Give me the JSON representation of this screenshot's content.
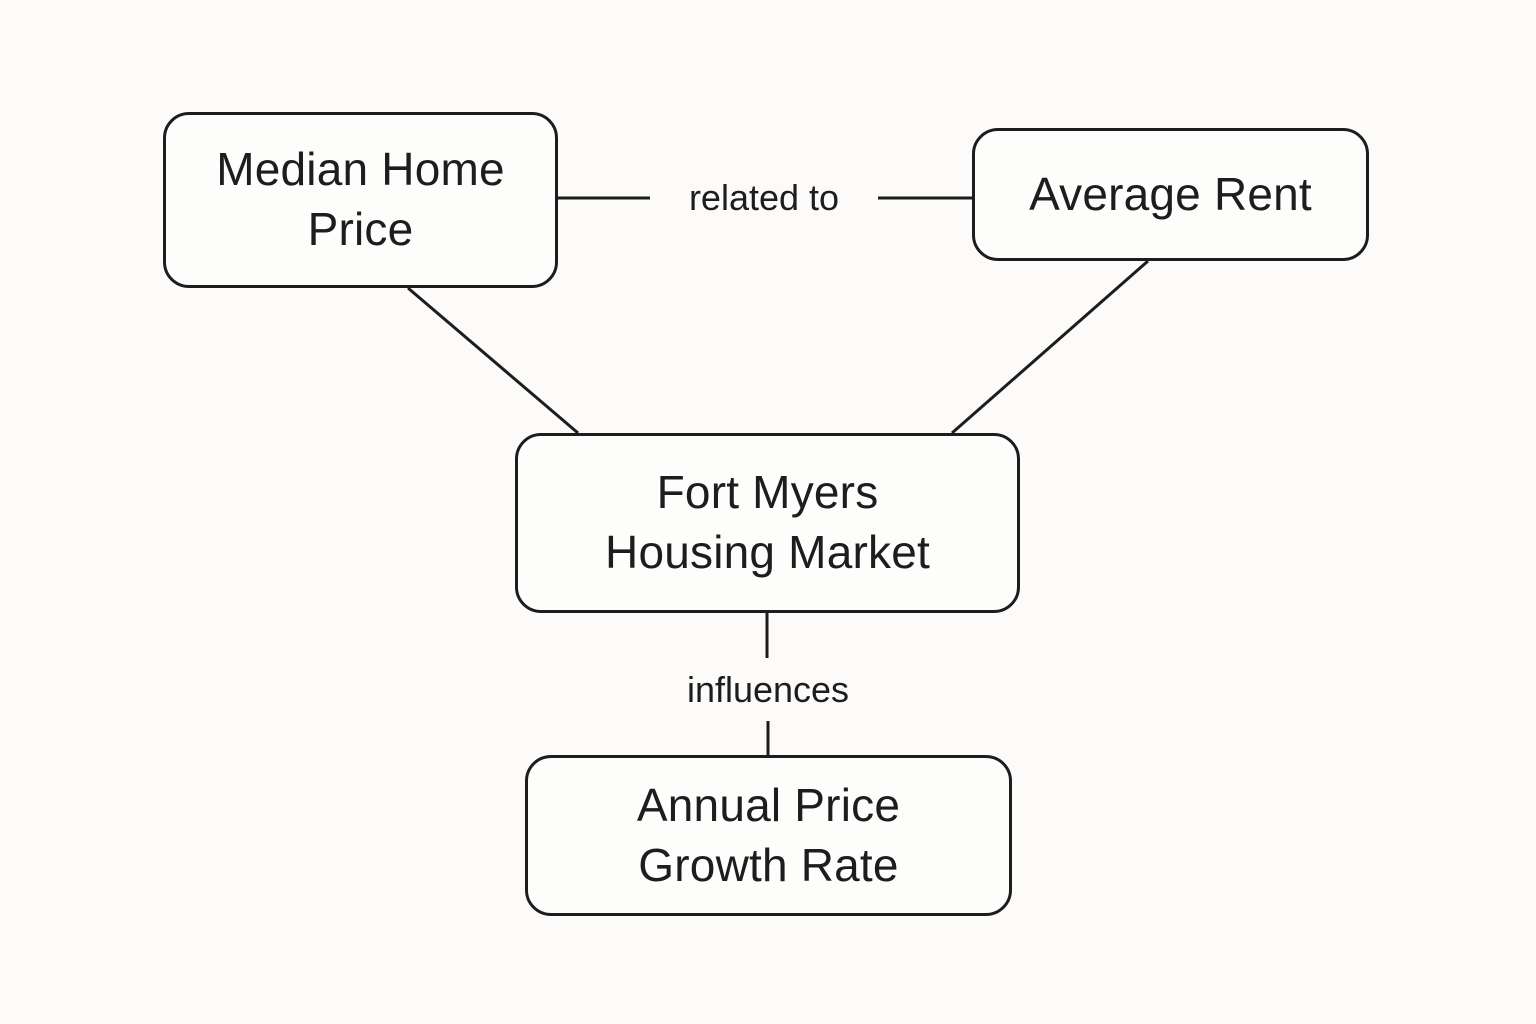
{
  "diagram": {
    "title": "Fort Myers Housing Market concept map",
    "nodes": {
      "median_home_price": {
        "label": "Median Home\nPrice"
      },
      "average_rent": {
        "label": "Average Rent"
      },
      "fort_myers_housing_market": {
        "label": "Fort Myers\nHousing Market"
      },
      "annual_price_growth_rate": {
        "label": "Annual Price\nGrowth Rate"
      }
    },
    "edges": [
      {
        "from": "Median Home Price",
        "to": "Average Rent",
        "label": "related to"
      },
      {
        "from": "Median Home Price",
        "to": "Fort Myers Housing Market",
        "label": ""
      },
      {
        "from": "Average Rent",
        "to": "Fort Myers Housing Market",
        "label": ""
      },
      {
        "from": "Fort Myers Housing Market",
        "to": "Annual Price Growth Rate",
        "label": "influences"
      }
    ],
    "colors": {
      "ink": "#1d1d1d",
      "background": "#fcfbf9",
      "node_fill": "#fdfdfc"
    }
  }
}
